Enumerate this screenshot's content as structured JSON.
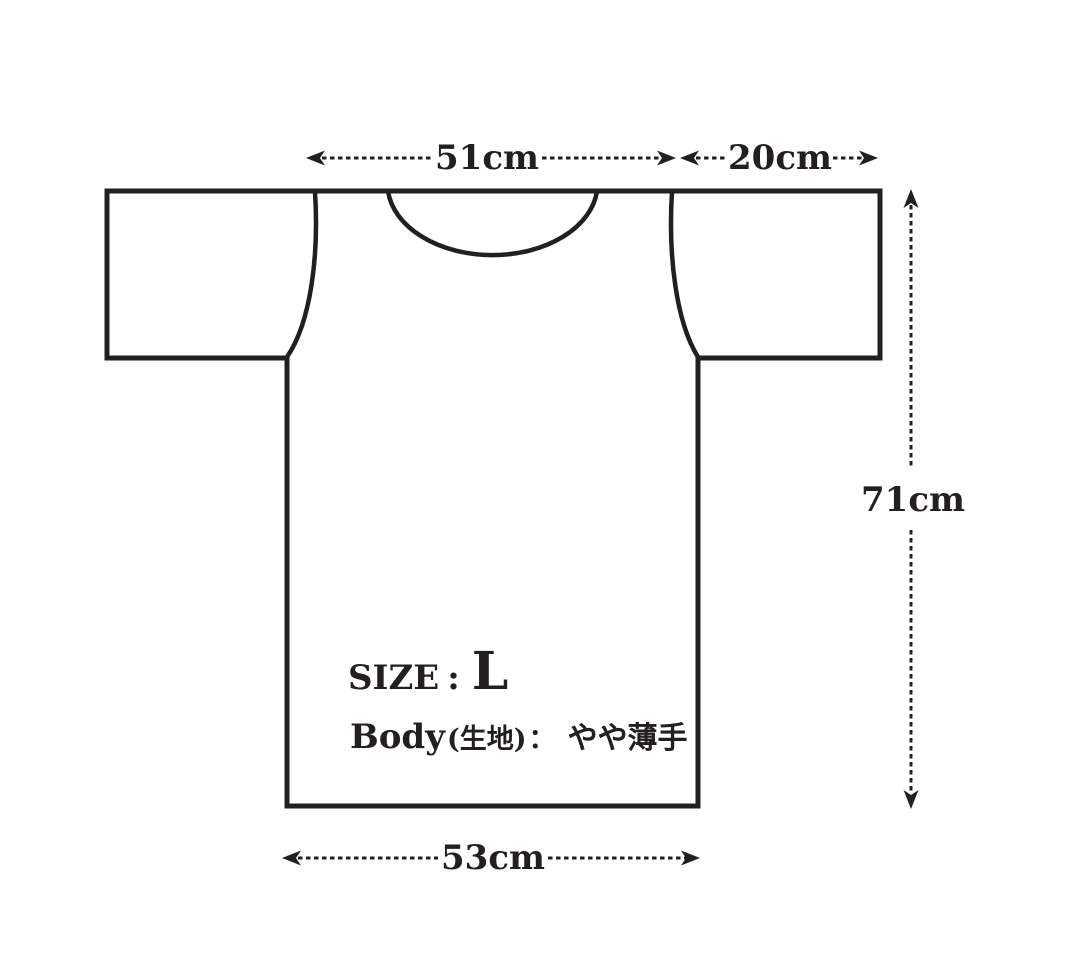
{
  "diagram": {
    "type": "t-shirt size specification diagram",
    "line_color": "#231f20",
    "background_color": "#ffffff",
    "dimensions": {
      "shoulder_width": "51cm",
      "sleeve_length": "20cm",
      "body_length": "71cm",
      "body_width": "53cm"
    },
    "info": {
      "size_label": "SIZE",
      "size_colon": ":",
      "size_value": "L",
      "fabric_label": "Body",
      "fabric_sublabel": "(生地)",
      "fabric_colon": "：",
      "fabric_value": "やや薄手"
    }
  }
}
